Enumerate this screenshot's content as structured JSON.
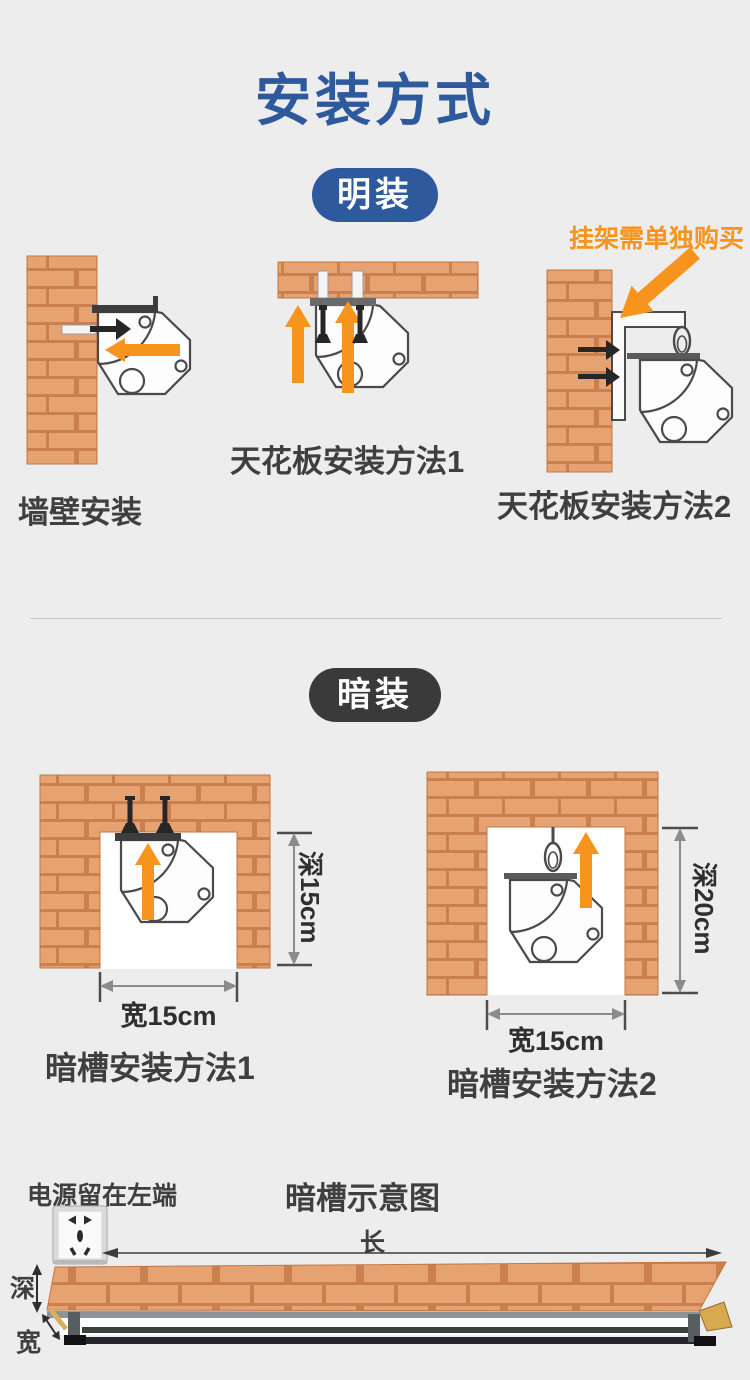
{
  "page": {
    "title": "安装方式"
  },
  "colors": {
    "background": "#ededee",
    "accent_blue": "#2e5a9d",
    "accent_orange": "#f7941d",
    "badge_dark": "#3a3a3a",
    "brick_fill": "#e7a271",
    "brick_mortar": "#c97f4e"
  },
  "surface_section": {
    "badge": "明装",
    "note": "挂架需单独购买",
    "wall_label": "墙壁安装",
    "ceiling1_label": "天花板安装方法1",
    "ceiling2_label": "天花板安装方法2"
  },
  "concealed_section": {
    "badge": "暗装",
    "method1": {
      "label": "暗槽安装方法1",
      "depth": "深15cm",
      "width": "宽15cm"
    },
    "method2": {
      "label": "暗槽安装方法2",
      "depth": "深20cm",
      "width": "宽15cm"
    }
  },
  "schematic_section": {
    "title": "暗槽示意图",
    "power_note": "电源留在左端",
    "length_label": "长",
    "depth_label": "深",
    "width_label": "宽"
  },
  "icons": {
    "curtain_motor": "octagonal-motor-cross-section",
    "screw": "black-screw",
    "wall_anchor": "white-wall-plug",
    "carabiner": "spring-hook",
    "l_bracket": "l-shaped-hanging-bracket",
    "power_outlet": "cn-5-hole-socket",
    "orange_arrow": "solid-orange-direction-arrow",
    "dimension_arrow": "gray-double-headed-arrow"
  }
}
